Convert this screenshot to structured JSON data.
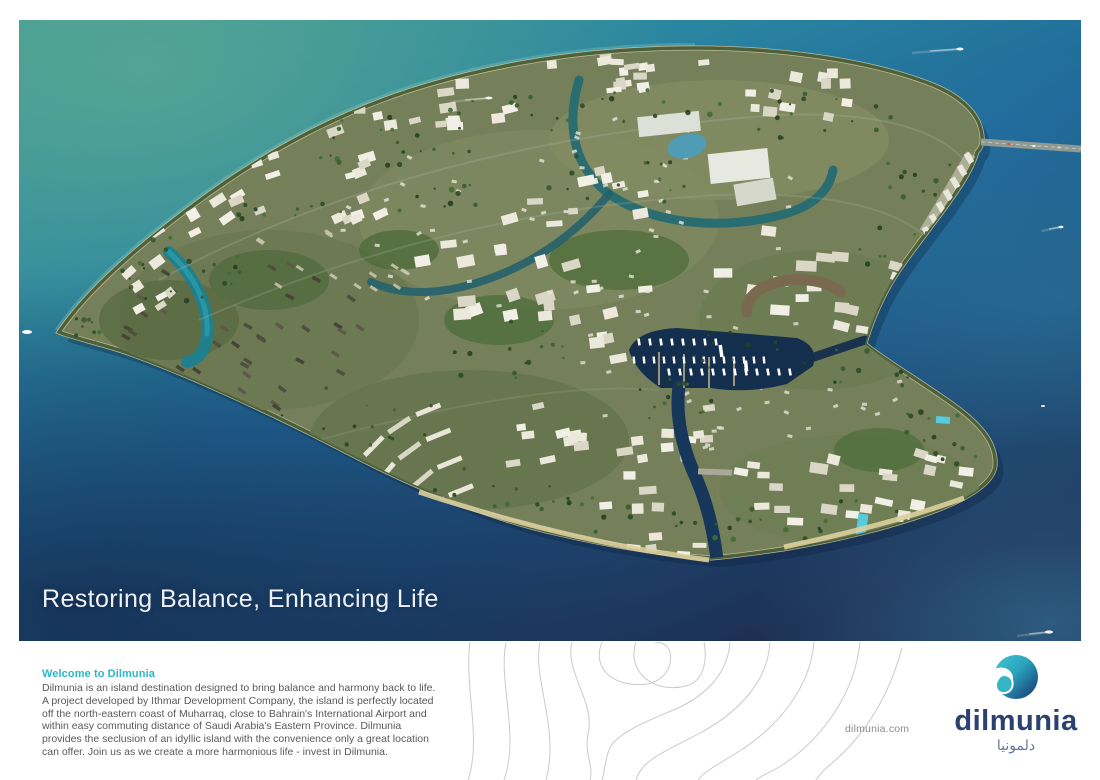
{
  "hero": {
    "tagline": "Restoring Balance, Enhancing Life"
  },
  "footer": {
    "welcome_heading": "Welcome to Dilmunia",
    "about_paragraph": "Dilmunia is an island destination designed to bring balance and harmony back to life. A project developed by Ithmar Development Company, the island is perfectly located off the north-eastern coast of Muharraq, close to Bahrain's International Airport and within easy commuting distance of Saudi Arabia's Eastern Province. Dilmunia provides the seclusion of an idyllic island with the convenience only a great location can offer. Join us as we create a more harmonious life - invest in Dilmunia.",
    "website": "dilmunia.com"
  },
  "brand": {
    "wordmark": "dilmunia",
    "wordmark_arabic": "دلمونيا",
    "accent_teal": "#29b7c9",
    "navy": "#2b4170",
    "arabic_blue": "#64779c",
    "body_text_gray": "#58595b"
  },
  "scene": {
    "label": "aerial-render-of-dilmunia-island",
    "sea_teal": "#3f9a95",
    "sea_mid": "#20689a",
    "sea_deep": "#1d2f52",
    "island_base": "#75805a",
    "sand": "#cdbf93",
    "coast_green": "#2d4b28",
    "marina_water": "#142e4e",
    "canal_teal": "#1f7f8c",
    "canal_dark": "#16375a",
    "building_light": "#ece9dc",
    "building_shade": "#dad7c7",
    "villa_dark": "#504e3e",
    "tree_green": "#2c4a28",
    "pool_blue": "#56cbe0",
    "road_gray": "#8f9a93"
  }
}
